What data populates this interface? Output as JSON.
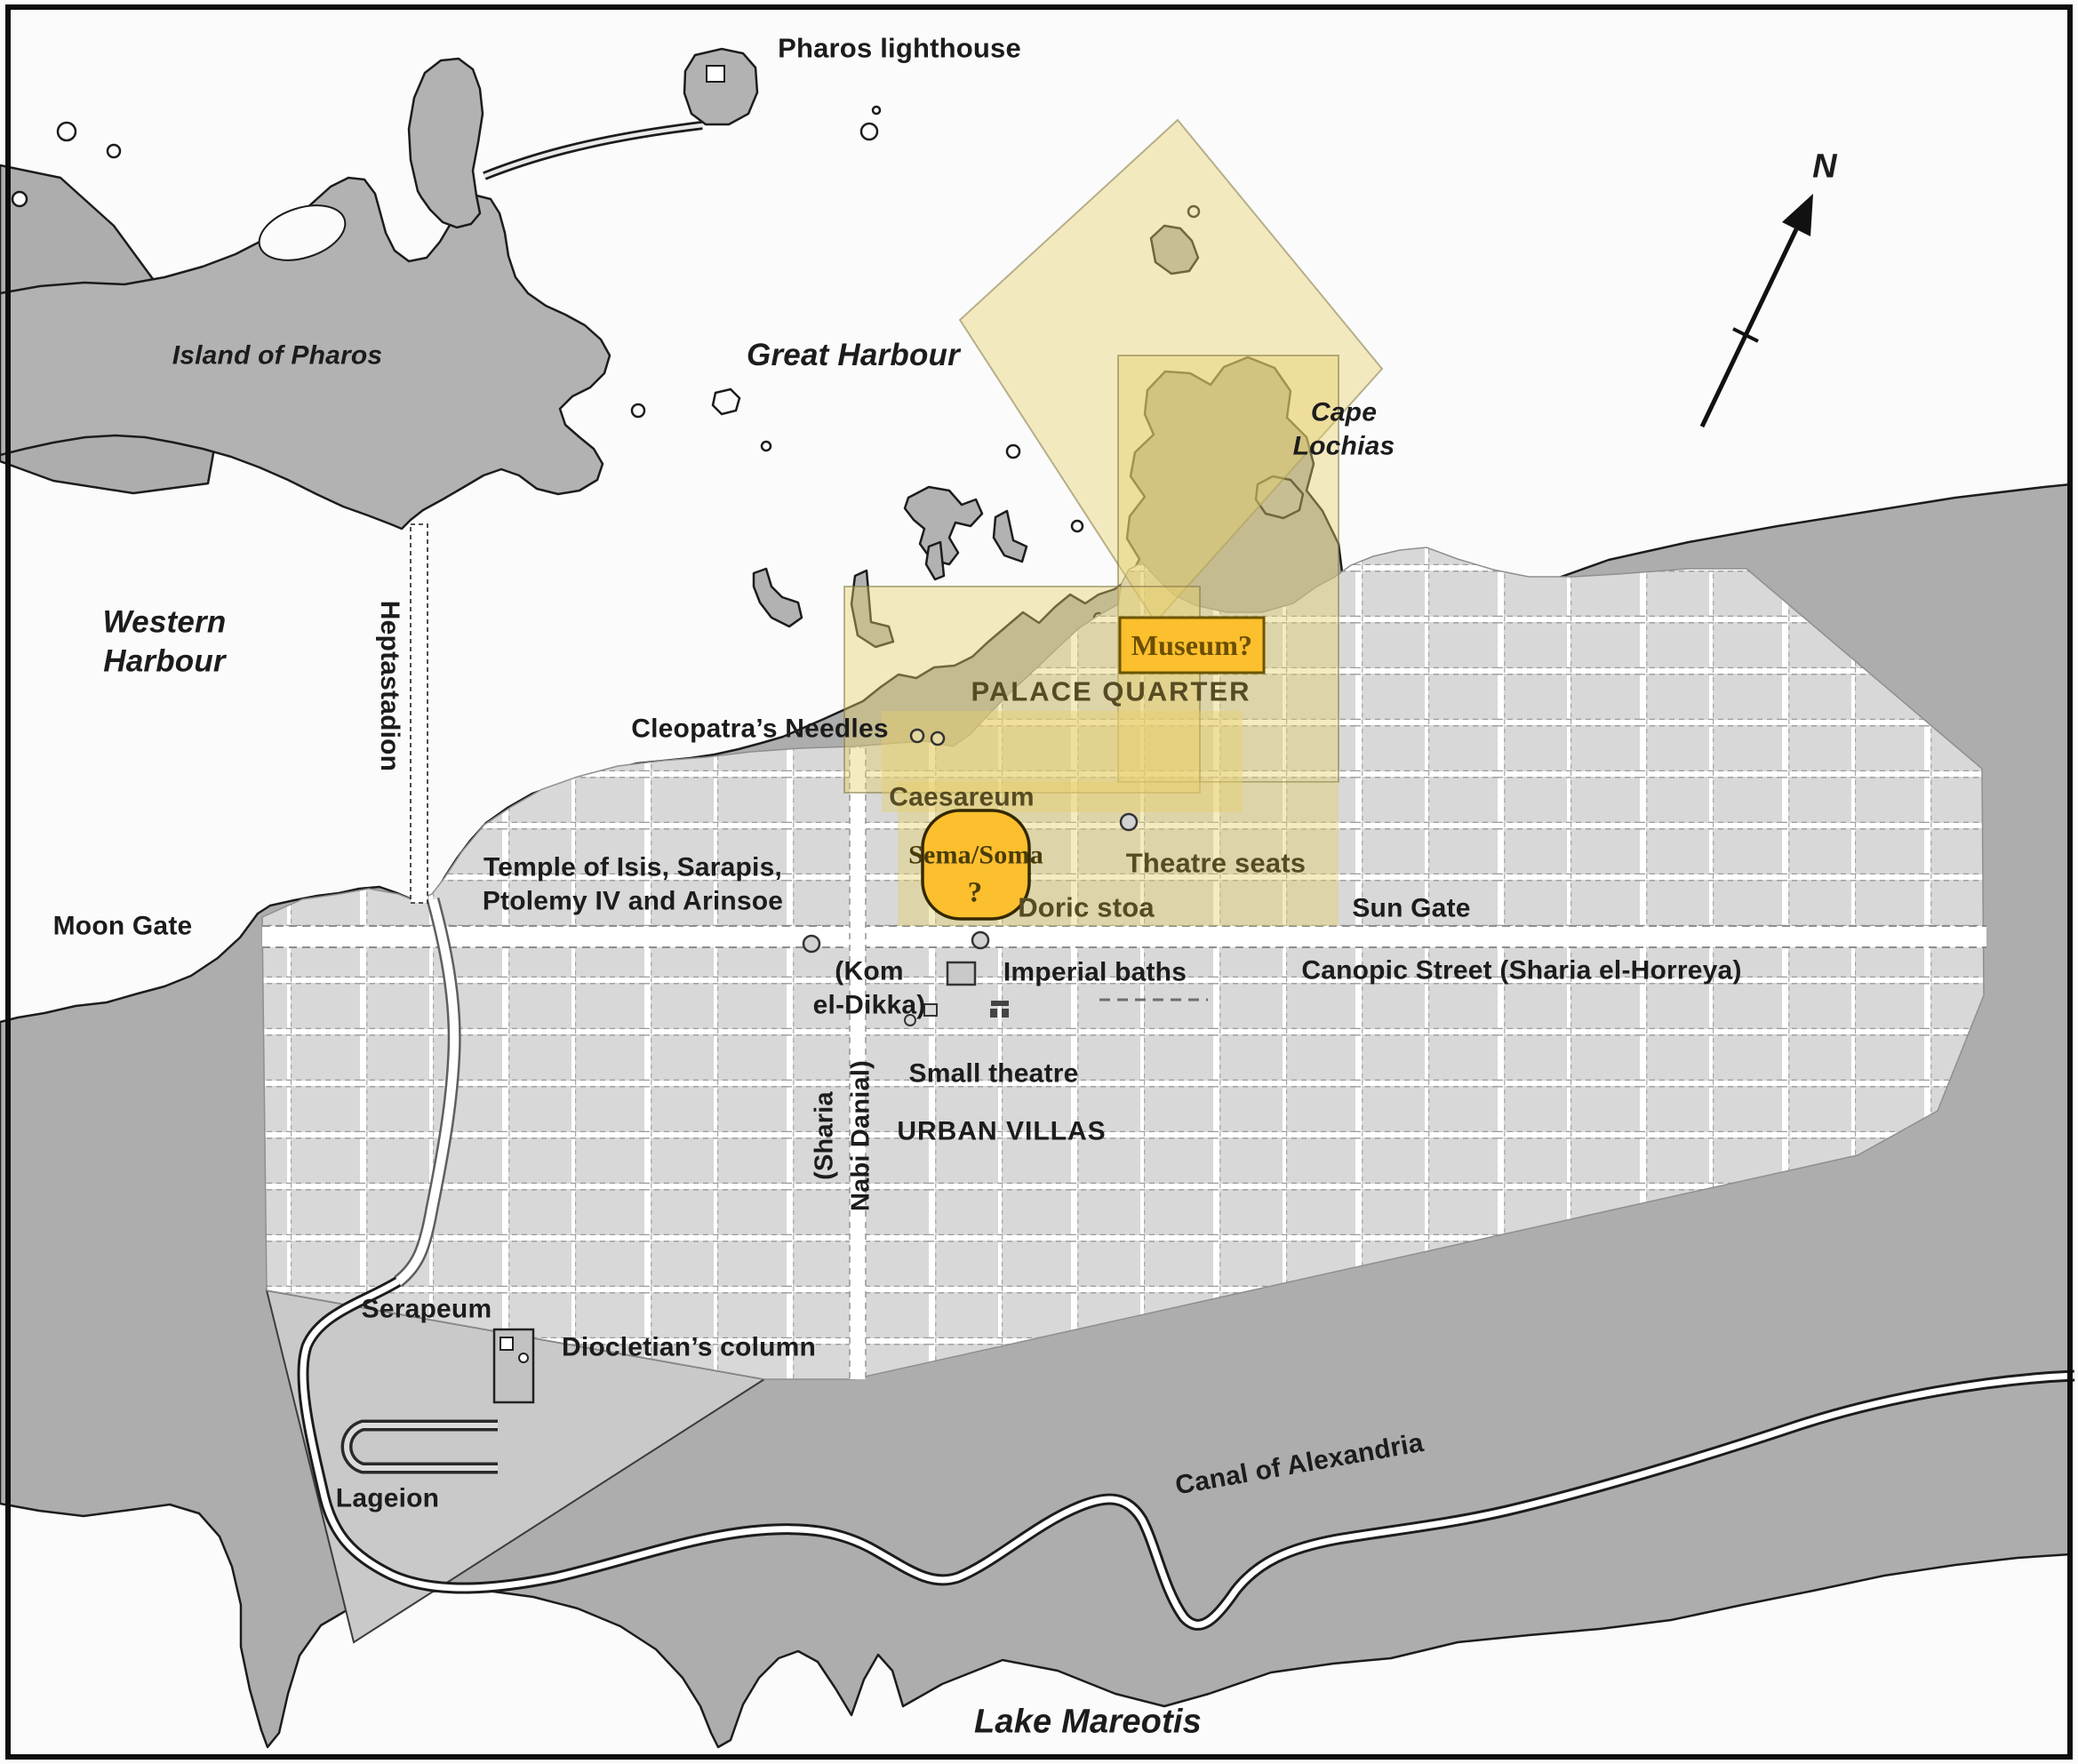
{
  "water_labels": {
    "great_harbour": "Great Harbour",
    "western_harbour": "Western\nHarbour",
    "lake_mareotis": "Lake Mareotis",
    "canal_of_alexandria": "Canal of Alexandria"
  },
  "land_labels": {
    "pharos_lighthouse": "Pharos lighthouse",
    "island_of_pharos": "Island of Pharos",
    "cape_lochias": "Cape\nLochias",
    "heptastadion": "Heptastadion",
    "moon_gate": "Moon Gate",
    "sun_gate": "Sun Gate",
    "canopic_street": "Canopic Street (Sharia el-Horreya)",
    "cleopatras_needles": "Cleopatra’s Needles",
    "temple_of_isis": "Temple of Isis, Sarapis,\nPtolemy IV and Arinsoe",
    "caesareum": "Caesareum",
    "palace_quarter": "PALACE QUARTER",
    "theatre_seats": "Theatre seats",
    "doric_stoa": "Doric stoa",
    "kom_el_dikka": "(Kom\nel-Dikka)",
    "imperial_baths": "Imperial baths",
    "small_theatre": "Small theatre",
    "urban_villas": "URBAN VILLAS",
    "sharia_nabi_danial": "(Sharia\nNabi Danial)",
    "serapeum": "Serapeum",
    "diocletians_column": "Diocletian’s column",
    "lageion": "Lageion"
  },
  "highlight_labels": {
    "museum": "Museum?",
    "sema_soma": "Sema/Soma",
    "sema_soma_query": "?"
  },
  "compass": {
    "north": "N"
  },
  "colors": {
    "water": "#fbfbfb",
    "land_gray": "#adadad",
    "city_block_gray": "#d8d8d8",
    "highlight_yellow": "#e7cf6b",
    "highlight_orange": "#fcbf2d",
    "ink": "#1c1c1c"
  }
}
